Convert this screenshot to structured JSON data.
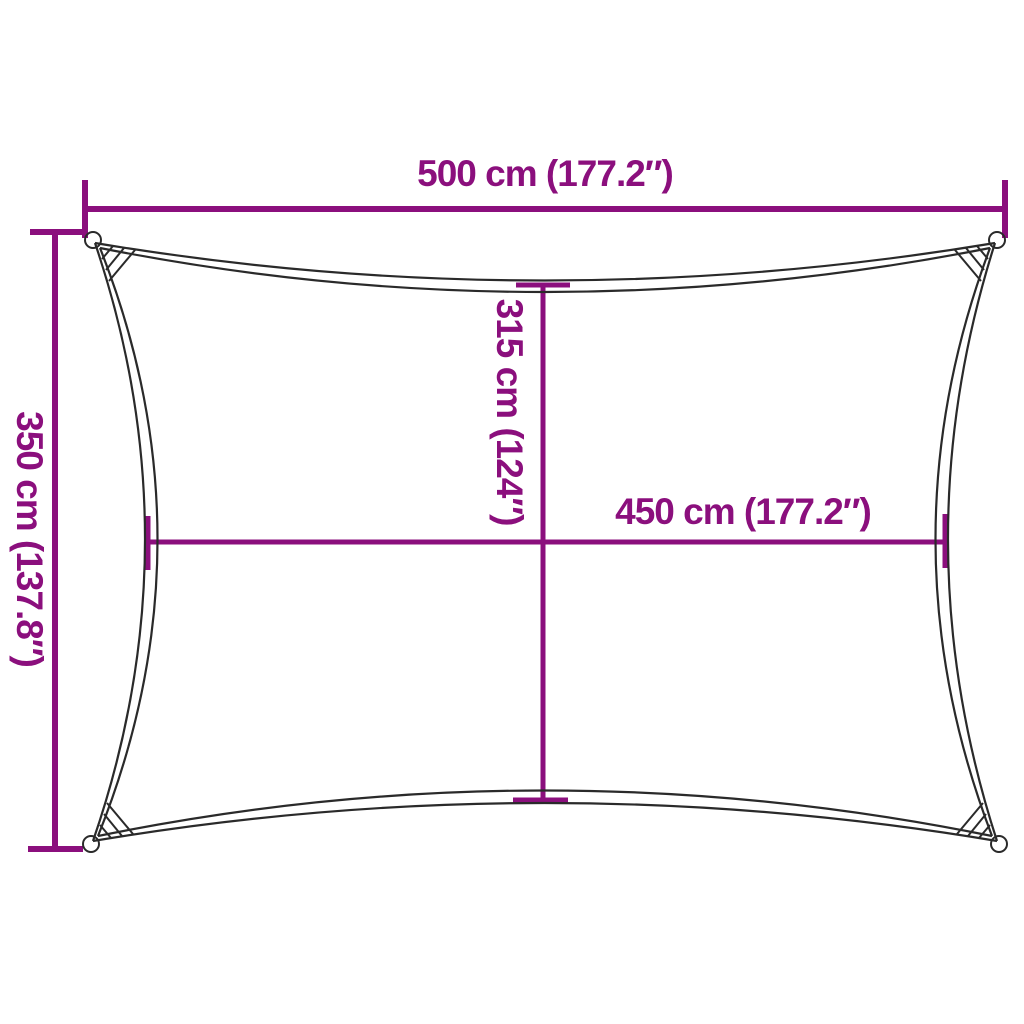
{
  "diagram": {
    "type": "product-dimension-diagram",
    "subject": "rectangular shade sail",
    "labels": {
      "top_width": "500 cm (177.2″)",
      "left_height": "350 cm (137.8″)",
      "inner_height": "315 cm (124″)",
      "inner_width": "450 cm (177.2″)"
    },
    "measurements": {
      "top_width_cm": 500,
      "top_width_in": 177.2,
      "left_height_cm": 350,
      "left_height_in": 137.8,
      "inner_height_cm": 315,
      "inner_height_in": 124,
      "inner_width_cm": 450,
      "inner_width_in": 177.2
    }
  },
  "colors": {
    "accent": "#8b0f7d",
    "outline": "#2a2a2a",
    "background": "#ffffff"
  }
}
